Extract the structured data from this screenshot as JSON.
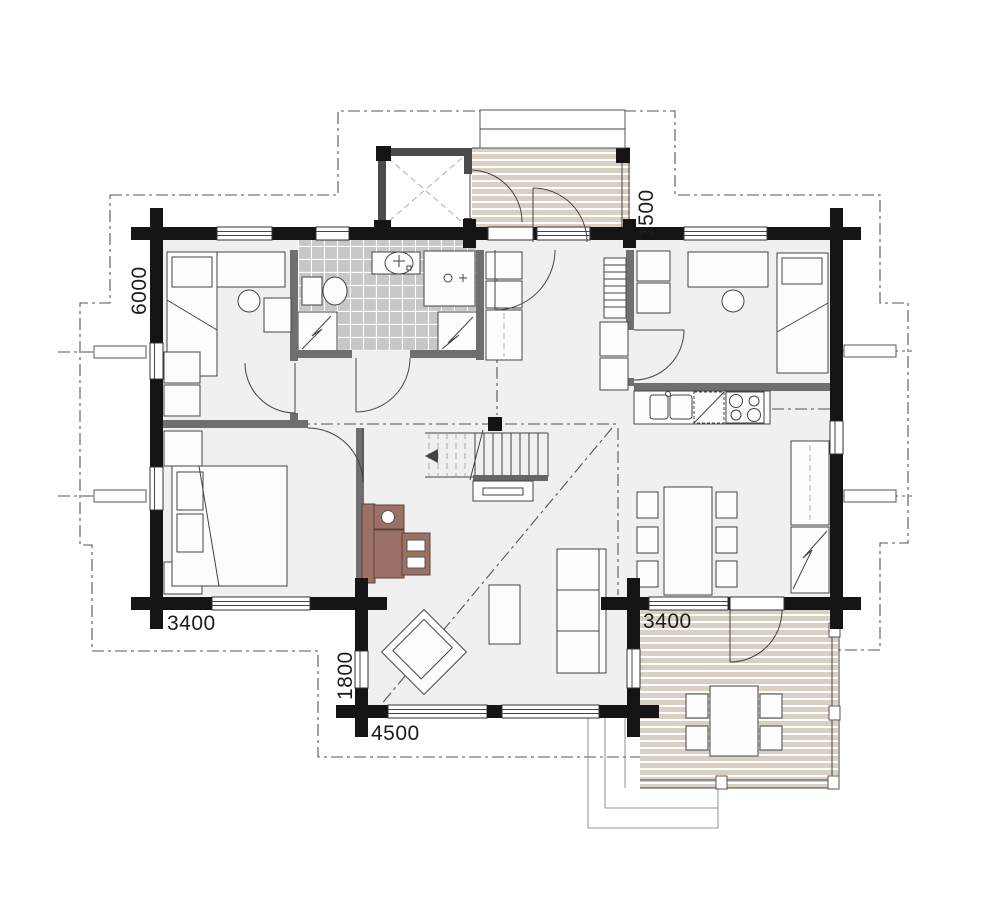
{
  "plan": {
    "type": "log-house floor plan, ground floor",
    "dimension_labels": {
      "left_wall_height": "6000",
      "entry_terrace_depth": "1500",
      "bedroom_width_bottom_left": "3400",
      "terrace_width_bottom_right": "3400",
      "living_room_side_offset": "1800",
      "living_room_width_bottom": "4500"
    },
    "colors": {
      "exterior_wall": "#141414",
      "interior_wall": "#6f6f6f",
      "storage_wall": "#4b4b4b",
      "floor": "#f0f0f0",
      "deck_board": "#d9cfc3",
      "bathroom_tile": "#c7c7c7",
      "desk_furniture_accent": "#9c7165",
      "reference_line": "#555555"
    },
    "fixtures": [
      "single-bed",
      "double-bed",
      "desk",
      "chair",
      "wardrobe",
      "toilet",
      "washbasin",
      "shower",
      "washing-machine",
      "kitchen-sink",
      "dishwasher",
      "stove",
      "fridge-freezer",
      "dining-table",
      "sofa",
      "armchair",
      "coffee-table",
      "stairs",
      "ladder",
      "entry-terrace",
      "dining-terrace",
      "outdoor-table"
    ]
  }
}
